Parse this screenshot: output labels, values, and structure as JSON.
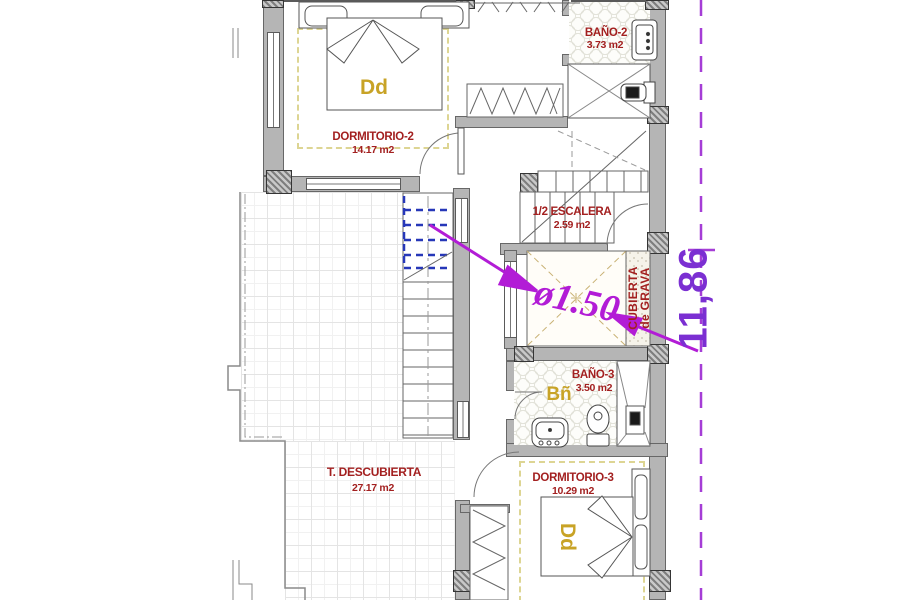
{
  "plan": {
    "type": "architectural-floor-plan",
    "rooms": {
      "dormitorio2": {
        "name": "DORMITORIO-2",
        "area": "14.17 m2",
        "code": "Dd"
      },
      "bano2": {
        "name": "BAÑO-2",
        "area": "3.73 m2"
      },
      "escalera": {
        "name": "1/2 ESCALERA",
        "area": "2.59 m2"
      },
      "cubierta_grava": {
        "line1": "CUBIERTA",
        "line2": "de GRAVA"
      },
      "bano3": {
        "name": "BAÑO-3",
        "area": "3.50 m2",
        "code": "Bñ"
      },
      "terraza": {
        "name": "T. DESCUBIERTA",
        "area": "27.17 m2"
      },
      "dormitorio3": {
        "name": "DORMITORIO-3",
        "area": "10.29 m2",
        "code": "Dd"
      }
    },
    "annotations": {
      "shaft_diameter": "ø1.50",
      "vertical_dimension": "11,86"
    },
    "colors": {
      "label_red": "#a32020",
      "code_yellow": "#c8a326",
      "annotation_magenta": "#b21cd6",
      "dimension_purple": "#7b2fd2",
      "wall_gray": "#b5b5b5",
      "stair_hidden_blue": "#2637b8",
      "lightwell_dash_tan": "#c9b275"
    }
  }
}
